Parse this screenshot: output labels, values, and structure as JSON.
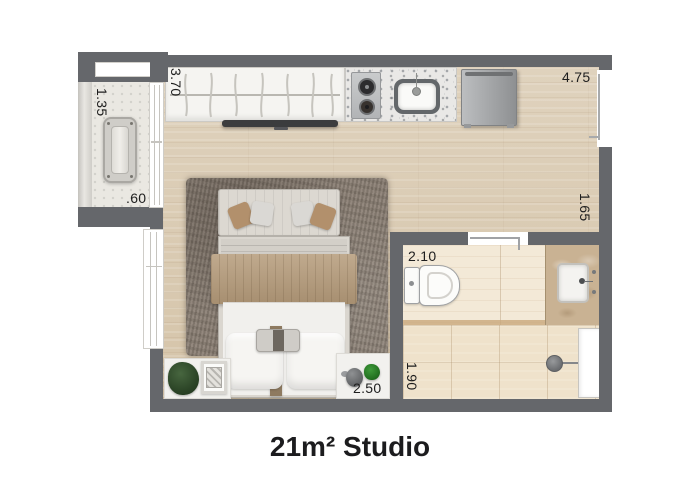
{
  "title": "21m² Studio",
  "dimensions": {
    "wardrobe_wall": "3.70",
    "balcony_width": "1.35",
    "balcony_depth": ".60",
    "top_wall": "4.75",
    "entry_wall": "1.65",
    "bathroom_width": "2.10",
    "bathroom_depth": "1.90",
    "foot_wall": "2.50"
  },
  "colors": {
    "wall": "#65676b",
    "wood_floor": "#dbcbb2",
    "balcony_floor": "#eae8e2",
    "bathroom_floor": "#f3e9d7",
    "shower_floor": "#efe2cb",
    "rug": "#8d8277",
    "throw_blanket": "#b59b7a",
    "vanity_marble": "#c9b293",
    "title_text": "#1c1c1e",
    "dimension_text": "#1e1e1e"
  },
  "furniture": [
    "wardrobe",
    "tv",
    "kitchen-counter",
    "cooktop",
    "kitchen-sink",
    "refrigerator",
    "sofa-bench",
    "double-bed",
    "area-rug",
    "ac-unit",
    "plant",
    "decor-frame",
    "vase-plant",
    "toilet",
    "bathroom-vanity",
    "shower-drain"
  ]
}
